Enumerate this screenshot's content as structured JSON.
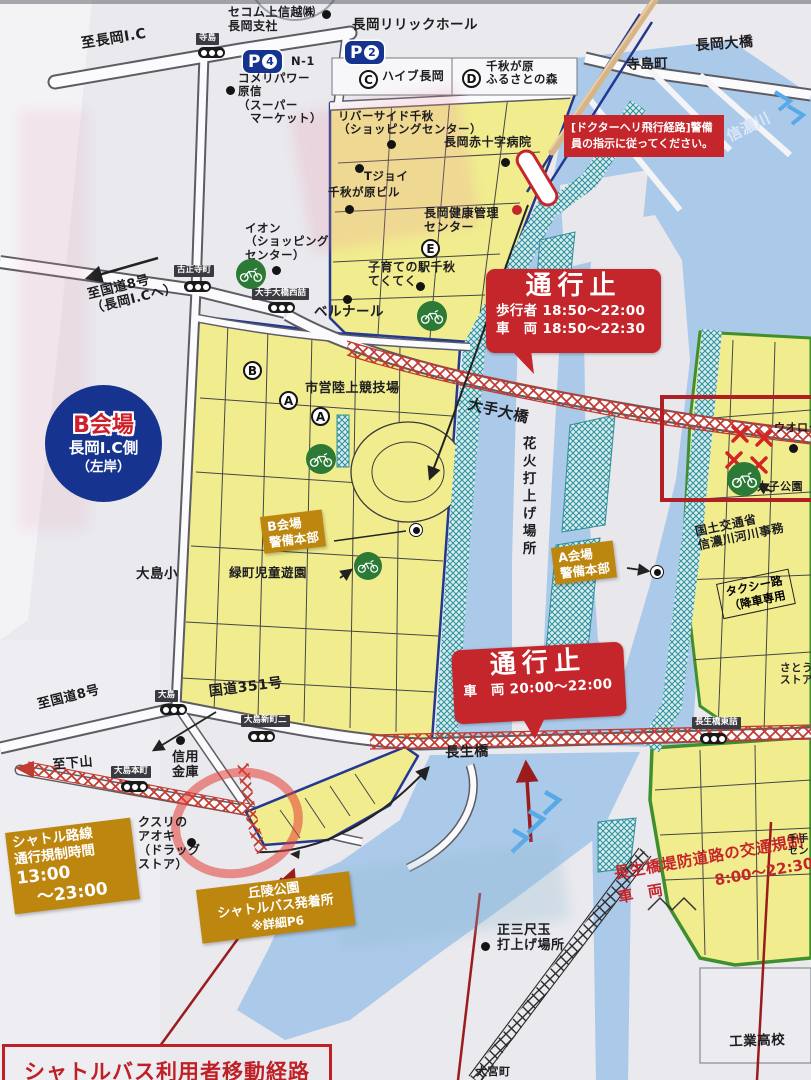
{
  "colors": {
    "zone_yellow": "#f1ed8e",
    "river_blue": "#abc9e9",
    "regulation_red": "#c5262b",
    "notice_ochre": "#bd860f",
    "badge_blue": "#16348f",
    "route_green": "#3f8f2f",
    "hatch_teal": "#2f8f9b"
  },
  "venue_badge": {
    "title": "B会場",
    "line2": "長岡I.C側",
    "line3": "（左岸）"
  },
  "parkings": {
    "p4": {
      "letter": "P",
      "number": "4",
      "code": "N-1"
    },
    "p2": {
      "letter": "P",
      "number": "2"
    },
    "c": {
      "letter": "C",
      "name": "ハイブ長岡"
    },
    "d": {
      "letter": "D",
      "name_l1": "千秋が原",
      "name_l2": "ふるさとの森"
    },
    "e": {
      "letter": "E"
    },
    "a1": {
      "letter": "A"
    },
    "a2": {
      "letter": "A"
    },
    "b": {
      "letter": "B"
    }
  },
  "alerts": {
    "heli": {
      "l1": "[ドクターヘリ飛行経路]",
      "l2": "警備員の指示に従ってく",
      "l3": "ださい。"
    },
    "closure_ote": {
      "title": "通行止",
      "l1": "歩行者 18:50～22:00",
      "l2": "車　両 18:50～22:30"
    },
    "closure_chosei": {
      "title": "通行止",
      "l1": "車　両 20:00～22:00"
    },
    "embankment": {
      "l1": "長生橋堤防道路の交通規制",
      "l2a": "車　両",
      "l2b": "8:00～22:30"
    },
    "shuttle_regulation": {
      "l1": "シャトル路線",
      "l2": "通行規制時間",
      "l3": "13:00",
      "l4": "～23:00"
    },
    "footer": "シャトルバス利用者移動経路"
  },
  "hq": {
    "b": {
      "l1": "B会場",
      "l2": "警備本部"
    },
    "a": {
      "l1": "A会場",
      "l2": "警備本部"
    }
  },
  "shuttle_stop": {
    "l1": "丘陵公園",
    "l2": "シャトルバス発着所",
    "l3": "※詳細P6"
  },
  "bridges": {
    "nagaoka": "長岡大橋",
    "ote": "大手大橋",
    "chosei": "長生橋"
  },
  "river": "信濃川",
  "roads": {
    "to_nagaoka_ic": "至長岡I.C",
    "to_r8_ic_l1": "至国道8号",
    "to_r8_ic_l2": "（長岡I.Cへ）",
    "r351": "国道351号",
    "to_r8": "至国道8号",
    "to_shimoyama": "至下山"
  },
  "signals": {
    "terashima": "寺島",
    "koshoji": "古正寺町",
    "otebashi_w": "大手大橋西詰",
    "oshima": "大島",
    "oshima_shin2": "大島新町二",
    "oshima_hon": "大島本町",
    "chosei_e": "長生橋東詰"
  },
  "places": {
    "secom": {
      "l1": "セコム上信越㈱",
      "l2": "長岡支社"
    },
    "lyric": "長岡リリックホール",
    "komeri": {
      "l1": "コメリパワー",
      "l2": "原信",
      "l3": "（スーパー",
      "l4": "　マーケット）"
    },
    "terashima_cho": "寺島町",
    "riverside": {
      "l1": "リバーサイド千秋",
      "l2": "（ショッピングセンター）"
    },
    "redcross": "長岡赤十字病院",
    "tjoy": "Tジョイ",
    "senshu_bldg": "千秋が原ビル",
    "ion": {
      "l1": "イオン",
      "l2": "（ショッピング",
      "l3": "センター）"
    },
    "kenko": {
      "l1": "長岡健康管理",
      "l2": "センター"
    },
    "kosodate": {
      "l1": "子育ての駅千秋",
      "l2": "てくてく"
    },
    "bernard": "ベルナール",
    "stadium": "市営陸上競技場",
    "midori": "緑町児童遊園",
    "oshima_elem": "大島小",
    "hanabi": "花火打上げ場所",
    "mlit": {
      "l1": "国土交通省",
      "l2": "信濃川河川事務"
    },
    "taxi": {
      "l1": "タクシー路",
      "l2": "（降車専用"
    },
    "taishi": "太子公園",
    "uoroku": "ウオロク",
    "sato": {
      "l1": "さとう",
      "l2": "ストア"
    },
    "shinkin": {
      "l1": "信用",
      "l2": "金庫"
    },
    "aoki": {
      "l1": "クスリの",
      "l2": "アオキ",
      "l3": "（ドラッグ",
      "l4": "ストア）"
    },
    "seisanjaku": {
      "l1": "正三尺玉",
      "l2": "打上げ場所"
    },
    "kogyo": "工業高校",
    "omiya": "大宮町",
    "senju": {
      "l1": "千手",
      "l2": "セン"
    }
  }
}
